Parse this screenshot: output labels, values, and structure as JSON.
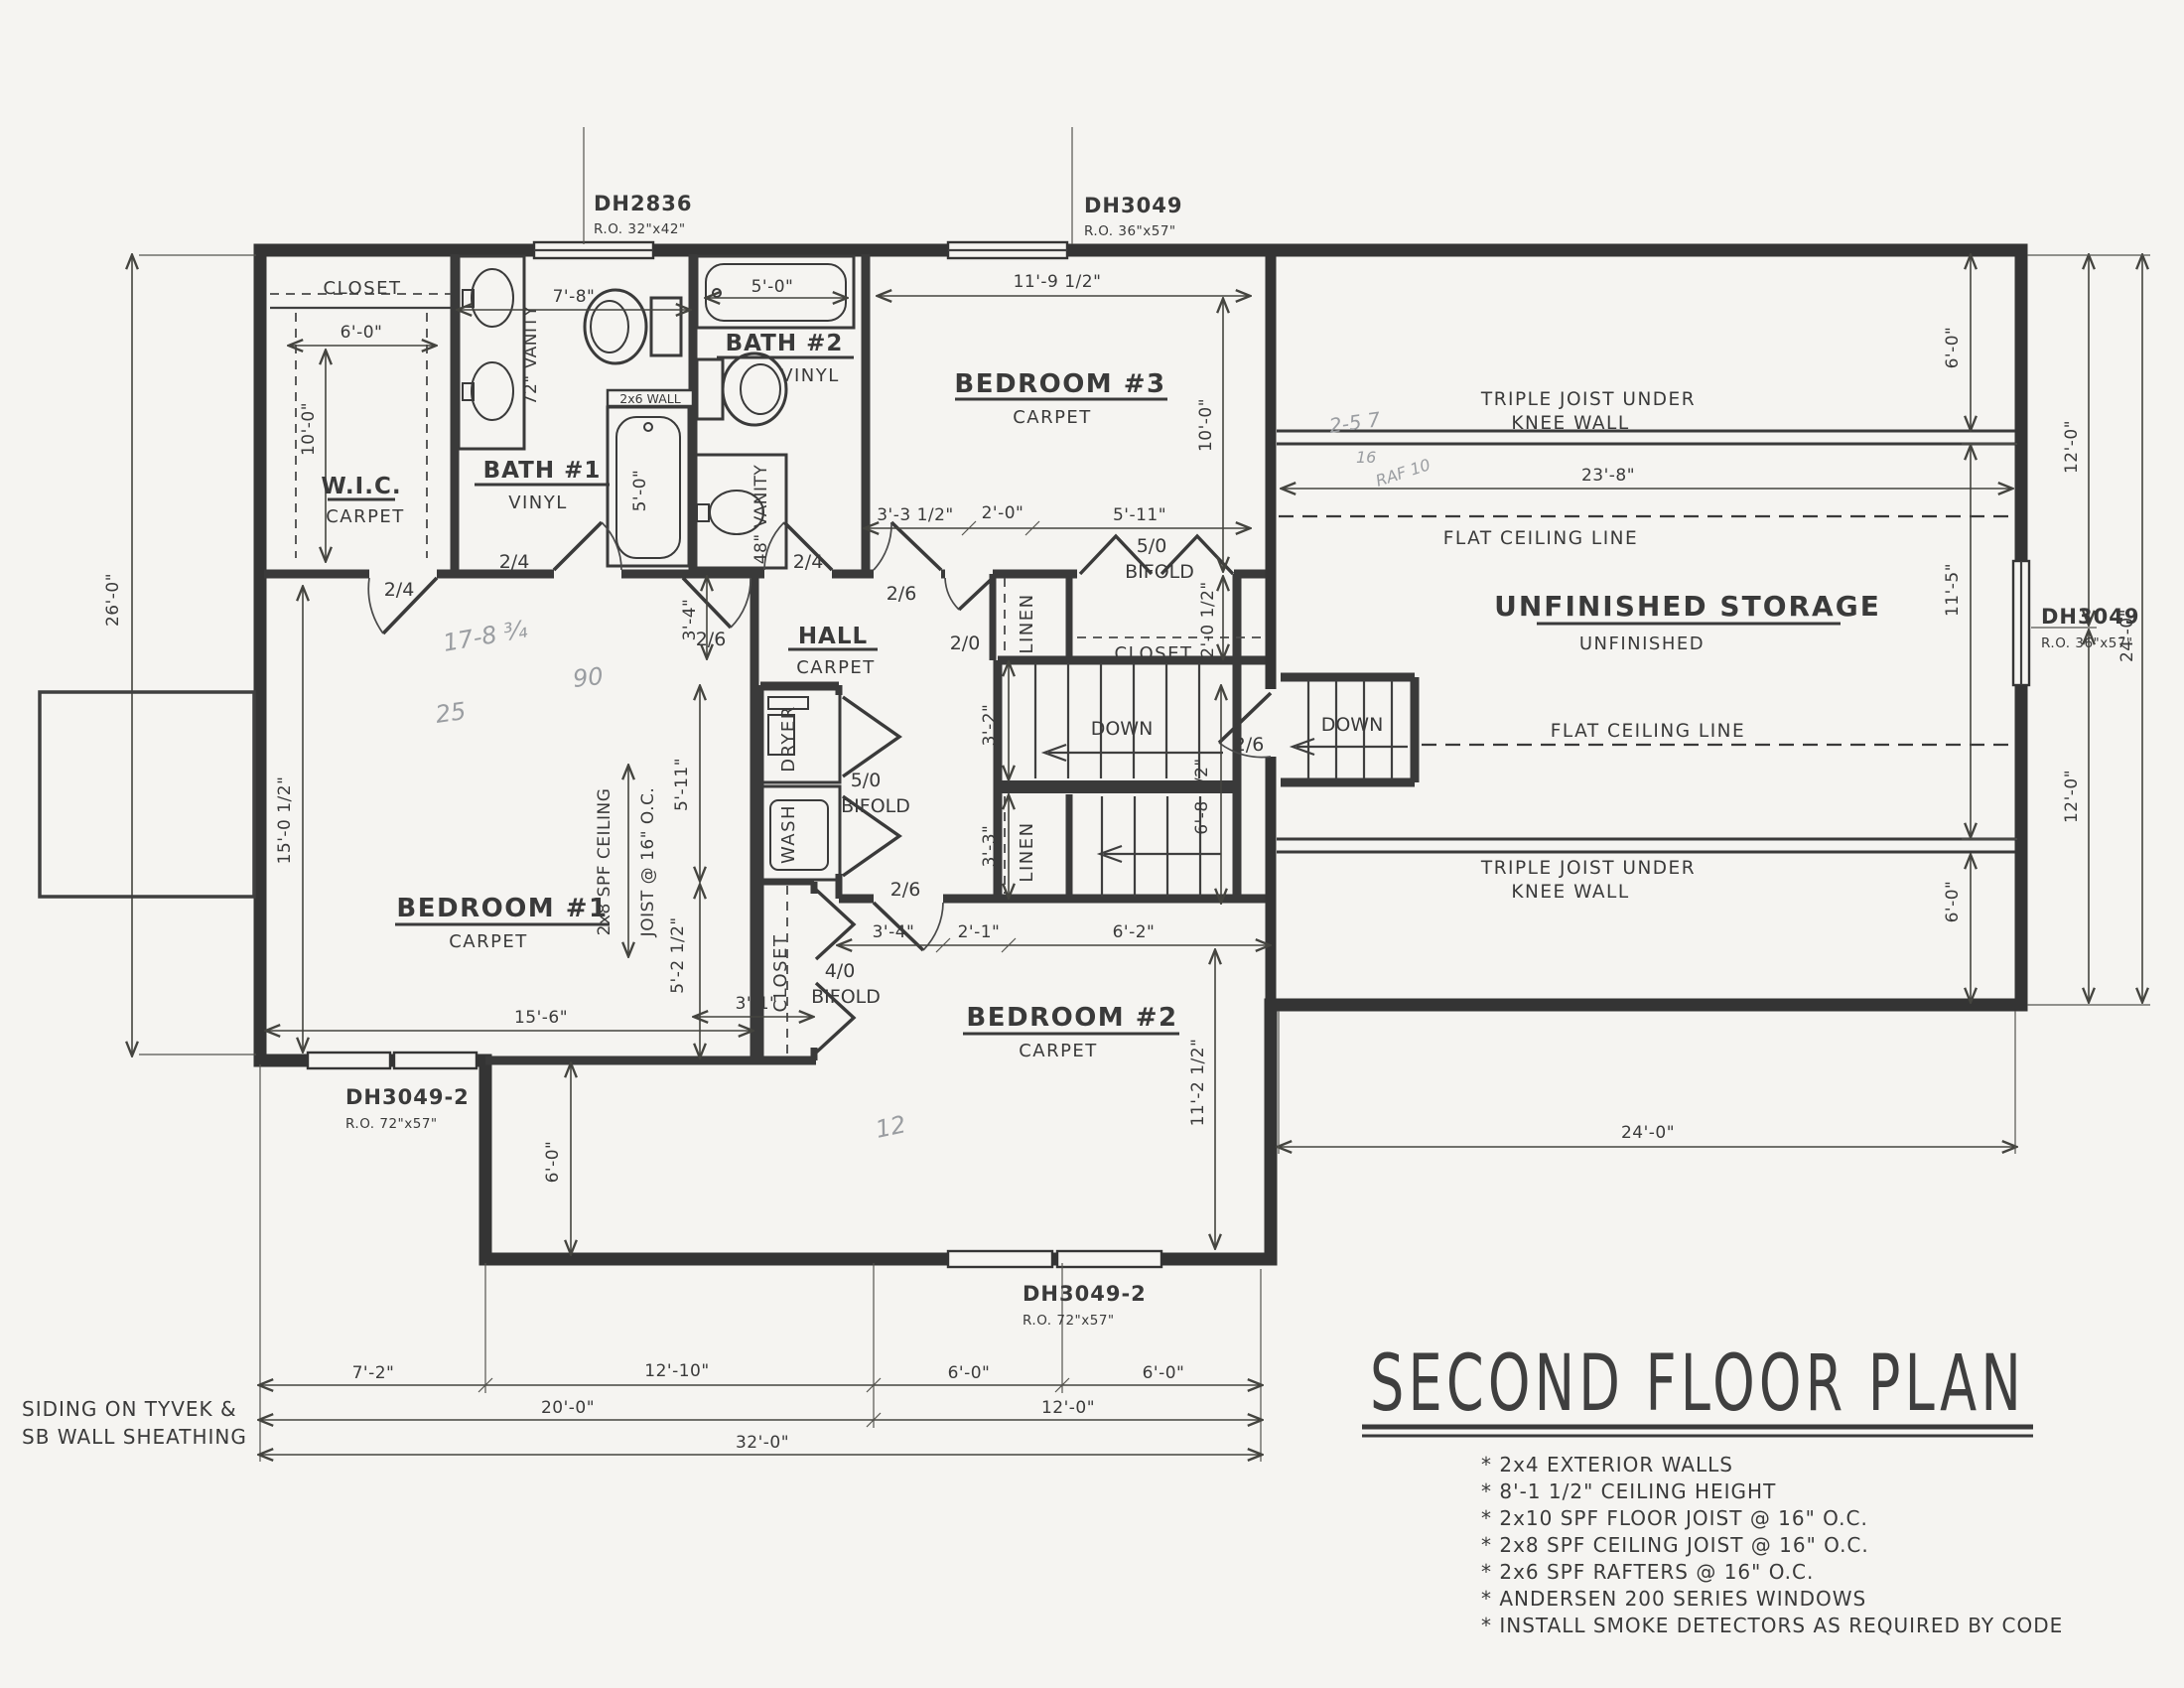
{
  "colors": {
    "paper": "#f5f4f1",
    "ink": "#3a3a3a",
    "pencil": "#9a9da1"
  },
  "title": "SECOND FLOOR PLAN",
  "notes": [
    "* 2x4 EXTERIOR WALLS",
    "* 8'-1 1/2\" CEILING HEIGHT",
    "* 2x10 SPF FLOOR JOIST @ 16\" O.C.",
    "* 2x8 SPF CEILING JOIST @ 16\" O.C.",
    "* 2x6 SPF RAFTERS @ 16\" O.C.",
    "* ANDERSEN 200 SERIES WINDOWS",
    "* INSTALL SMOKE DETECTORS AS REQUIRED BY CODE"
  ],
  "siding": {
    "l1": "SIDING ON TYVEK &",
    "l2": "SB WALL SHEATHING"
  },
  "windows": {
    "dh2836": {
      "model": "DH2836",
      "ro": "R.O. 32\"x42\""
    },
    "dh3049_top": {
      "model": "DH3049",
      "ro": "R.O. 36\"x57\""
    },
    "dh3049_right": {
      "model": "DH3049",
      "ro": "R.O. 36\"x57\""
    },
    "dh3049_2_left": {
      "model": "DH3049-2",
      "ro": "R.O. 72\"x57\""
    },
    "dh3049_2_mid": {
      "model": "DH3049-2",
      "ro": "R.O. 72\"x57\""
    }
  },
  "rooms": {
    "wic": {
      "name": "W.I.C.",
      "floor": "CARPET"
    },
    "bath1": {
      "name": "BATH #1",
      "floor": "VINYL"
    },
    "bath2": {
      "name": "BATH #2",
      "floor": "VINYL"
    },
    "bed1": {
      "name": "BEDROOM #1",
      "floor": "CARPET"
    },
    "bed2": {
      "name": "BEDROOM #2",
      "floor": "CARPET"
    },
    "bed3": {
      "name": "BEDROOM #3",
      "floor": "CARPET"
    },
    "hall": {
      "name": "HALL",
      "floor": "CARPET"
    },
    "storage": {
      "name": "UNFINISHED STORAGE",
      "sub": "UNFINISHED"
    }
  },
  "labels": {
    "triple_joist": "TRIPLE JOIST UNDER",
    "knee_wall": "KNEE WALL",
    "flat_ceiling": "FLAT CEILING LINE",
    "down": "DOWN",
    "linen": "LINEN",
    "closet": "CLOSET",
    "wash": "WASH",
    "dryer": "DRYER",
    "bifold": "BIFOLD",
    "b50": "5/0",
    "b40": "4/0",
    "wall2x6": "2x6 WALL",
    "vanity72": "72\" VANITY",
    "vanity48": "48\" VANITY",
    "joist1": "2x8 SPF CEILING",
    "joist2": "JOIST @ 16\" O.C."
  },
  "doors": {
    "d24": "2/4",
    "d26": "2/6",
    "d20": "2/0"
  },
  "dims": {
    "d26_0": "26'-0\"",
    "d6_0": "6'-0\"",
    "d10_0": "10'-0\"",
    "d15_0h": "15'-0 1/2\"",
    "d7_8": "7'-8\"",
    "d5_0": "5'-0\"",
    "d11_9h": "11'-9 1/2\"",
    "d3_3h": "3'-3 1/2\"",
    "d2_0": "2'-0\"",
    "d5_11": "5'-11\"",
    "d2_0h": "2'-0 1/2\"",
    "d3_4": "3'-4\"",
    "d5_2h": "5'-2 1/2\"",
    "d3_1": "3'-1\"",
    "d15_6": "15'-6\"",
    "d3_2": "3'-2\"",
    "d3_3": "3'-3\"",
    "d6_8h": "6'-8 1/2\"",
    "d2_1": "2'-1\"",
    "d6_2": "6'-2\"",
    "d11_2h": "11'-2 1/2\"",
    "d23_8": "23'-8\"",
    "d11_5": "11'-5\"",
    "d12_0": "12'-0\"",
    "d24_0": "24'-0\"",
    "d7_2": "7'-2\"",
    "d12_10": "12'-10\"",
    "d20_0": "20'-0\"",
    "d32_0": "32'-0\""
  },
  "pencil": {
    "p1": "17-8 ¾",
    "p2": "90",
    "p3": "25",
    "p4": "12",
    "p5": "2-5 7",
    "p6": "16",
    "p7": "RAF 10"
  }
}
